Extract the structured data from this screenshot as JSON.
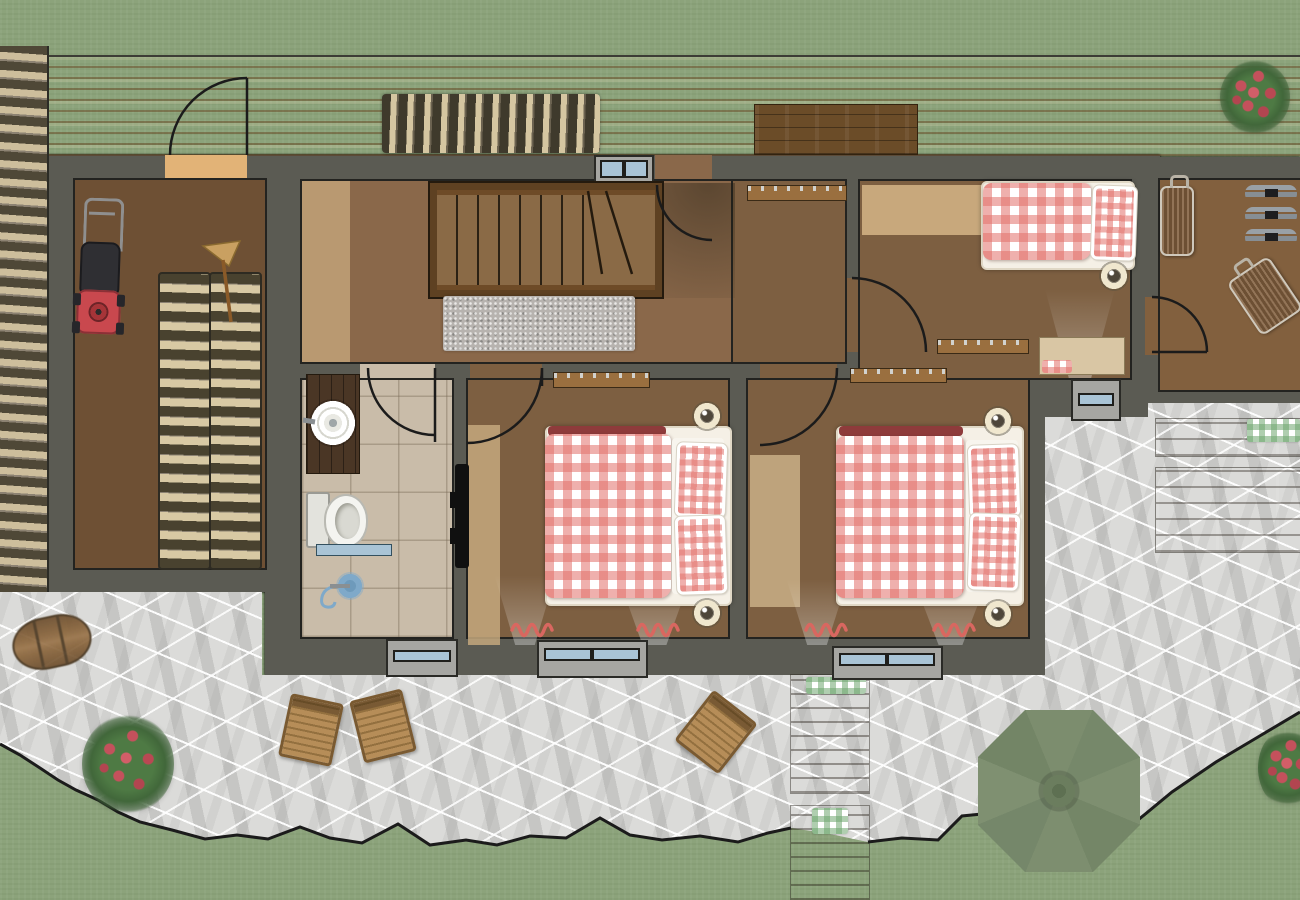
{
  "palette": {
    "grass": "#8CA37B",
    "stone": "#DBDBD9",
    "wall": "#5B5B53",
    "deck_light": "#E9C98F",
    "deck_dark": "#D1934E",
    "floor_dark": "#75563A",
    "floor_mid": "#8A684A",
    "floor_light": "#C2A379",
    "tile": "#C9BCA9",
    "gingham_red": "#E4807A",
    "gingham_green": "#92BE92",
    "window_glass": "#A9C4D6",
    "radiator_wood": "#9A6F3F",
    "spotlight_ring": "#EFE6CC",
    "umbrella_green": "#788A68",
    "flower_red": "#C4515C",
    "flower_green": "#4E7A44",
    "logs_light": "#CCBD9B",
    "logs_dark": "#4B4537",
    "mower_red": "#C9484E",
    "suitcase": "#70555E",
    "rug": "#B7B3AF"
  },
  "scene": {
    "type": "chalet floor plan rendering, top-down view",
    "inventory": {
      "double_beds_red_gingham": 3,
      "ceiling_spotlights": 5,
      "door_swing_arcs": 7,
      "windows": 5,
      "radiators": 4,
      "staircase_steps": 10,
      "wooden_folding_chairs": 3,
      "suitcases": 2,
      "ski_pairs_on_rack": 3,
      "flower_bushes": 3,
      "green_parasol": 1,
      "wooden_barrel": 1,
      "lawn_mower": 1,
      "broom": 1,
      "indoor_firewood_stacks": 2,
      "deck_firewood_stack": 1,
      "green_gingham_doormats": 3,
      "bedside_rug_squiggles": 4
    }
  }
}
